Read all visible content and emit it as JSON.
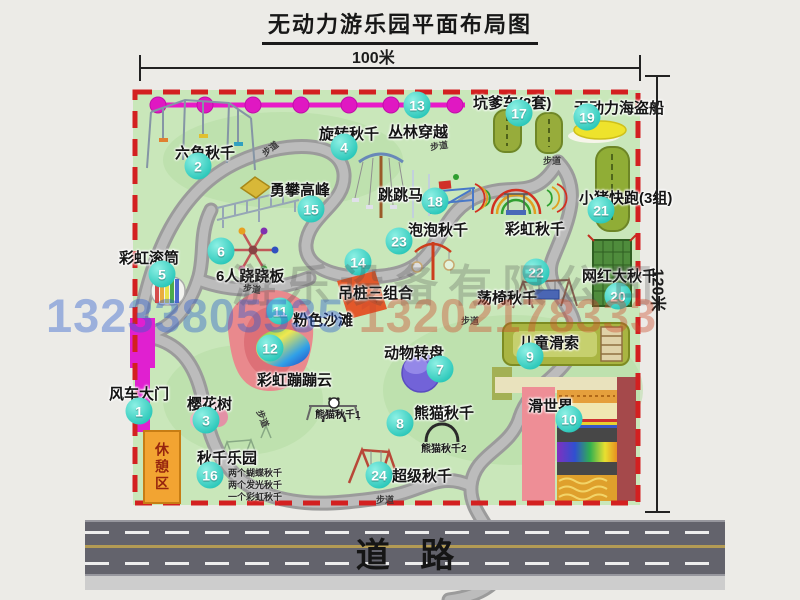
{
  "title": "无动力游乐园平面布局图",
  "dim": {
    "w": "100米",
    "h": "120米"
  },
  "road": {
    "label": "道路"
  },
  "rest_area": "休憩区",
  "path_label_text": "步道",
  "watermark": {
    "company": "游乐设备有限公司",
    "phones": [
      "13233805535",
      "13202178333"
    ]
  },
  "notes_16": [
    "两个蝴蝶秋千",
    "两个发光秋千",
    "一个彩虹秋千"
  ],
  "panda_subs": [
    "熊猫秋千1",
    "熊猫秋千2"
  ],
  "rainbow_swing_label": "彩虹秋千",
  "attractions": [
    {
      "num": "1",
      "label": "风车大门",
      "lx": -24,
      "ly": 293,
      "mx": 6,
      "my": 321
    },
    {
      "num": "2",
      "label": "六角秋千",
      "lx": 42,
      "ly": 52,
      "mx": 65,
      "my": 76
    },
    {
      "num": "3",
      "label": "樱花树",
      "lx": 54,
      "ly": 303,
      "mx": 73,
      "my": 330
    },
    {
      "num": "4",
      "label": "旋转秋千",
      "lx": 186,
      "ly": 33,
      "mx": 211,
      "my": 57
    },
    {
      "num": "5",
      "label": "彩虹滚筒",
      "lx": -14,
      "ly": 157,
      "mx": 29,
      "my": 184
    },
    {
      "num": "6",
      "label": "6人跷跷板",
      "lx": 83,
      "ly": 175,
      "mx": 88,
      "my": 161
    },
    {
      "num": "7",
      "label": "动物转盘",
      "lx": 251,
      "ly": 252,
      "mx": 307,
      "my": 279
    },
    {
      "num": "8",
      "label": "熊猫秋千",
      "lx": 281,
      "ly": 312,
      "mx": 267,
      "my": 333
    },
    {
      "num": "9",
      "label": "儿童滑索",
      "lx": 386,
      "ly": 242,
      "mx": 397,
      "my": 266
    },
    {
      "num": "10",
      "label": "滑世界",
      "lx": 395,
      "ly": 305,
      "mx": 436,
      "my": 329
    },
    {
      "num": "11",
      "label": "粉色沙滩",
      "lx": 160,
      "ly": 219,
      "mx": 147,
      "my": 221
    },
    {
      "num": "12",
      "label": "彩虹蹦蹦云",
      "lx": 124,
      "ly": 279,
      "mx": 137,
      "my": 258
    },
    {
      "num": "13",
      "label": "丛林穿越",
      "lx": 255,
      "ly": 31,
      "mx": 284,
      "my": 15
    },
    {
      "num": "14",
      "label": "吊桩三组合",
      "lx": 205,
      "ly": 192,
      "mx": 225,
      "my": 172
    },
    {
      "num": "15",
      "label": "勇攀高峰",
      "lx": 137,
      "ly": 89,
      "mx": 178,
      "my": 119
    },
    {
      "num": "16",
      "label": "秋千乐园",
      "lx": 64,
      "ly": 357,
      "mx": 77,
      "my": 385
    },
    {
      "num": "17",
      "label": "坑爹车(2套)",
      "lx": 340,
      "ly": 2,
      "mx": 386,
      "my": 23
    },
    {
      "num": "18",
      "label": "跳跳马",
      "lx": 245,
      "ly": 94,
      "mx": 302,
      "my": 111
    },
    {
      "num": "19",
      "label": "无动力海盗船",
      "lx": 441,
      "ly": 7,
      "mx": 454,
      "my": 27
    },
    {
      "num": "20",
      "label": "网红大秋千",
      "lx": 449,
      "ly": 175,
      "mx": 485,
      "my": 206
    },
    {
      "num": "21",
      "label": "小猪快跑(3组)",
      "lx": 446,
      "ly": 97,
      "mx": 468,
      "my": 120
    },
    {
      "num": "22",
      "label": "荡椅秋千",
      "lx": 344,
      "ly": 197,
      "mx": 403,
      "my": 182
    },
    {
      "num": "23",
      "label": "泡泡秋千",
      "lx": 275,
      "ly": 129,
      "mx": 266,
      "my": 151
    },
    {
      "num": "24",
      "label": "超级秋千",
      "lx": 259,
      "ly": 375,
      "mx": 246,
      "my": 385
    },
    {
      "num": null,
      "label": "彩虹秋千",
      "lx": 372,
      "ly": 128
    }
  ],
  "path_labels": [
    {
      "x": 128,
      "y": 52,
      "r": -38
    },
    {
      "x": 110,
      "y": 192,
      "r": 8
    },
    {
      "x": 297,
      "y": 49,
      "r": -8
    },
    {
      "x": 410,
      "y": 64,
      "r": 0
    },
    {
      "x": 328,
      "y": 224,
      "r": 0
    },
    {
      "x": 121,
      "y": 322,
      "r": 68
    },
    {
      "x": 243,
      "y": 403,
      "r": 0
    }
  ]
}
